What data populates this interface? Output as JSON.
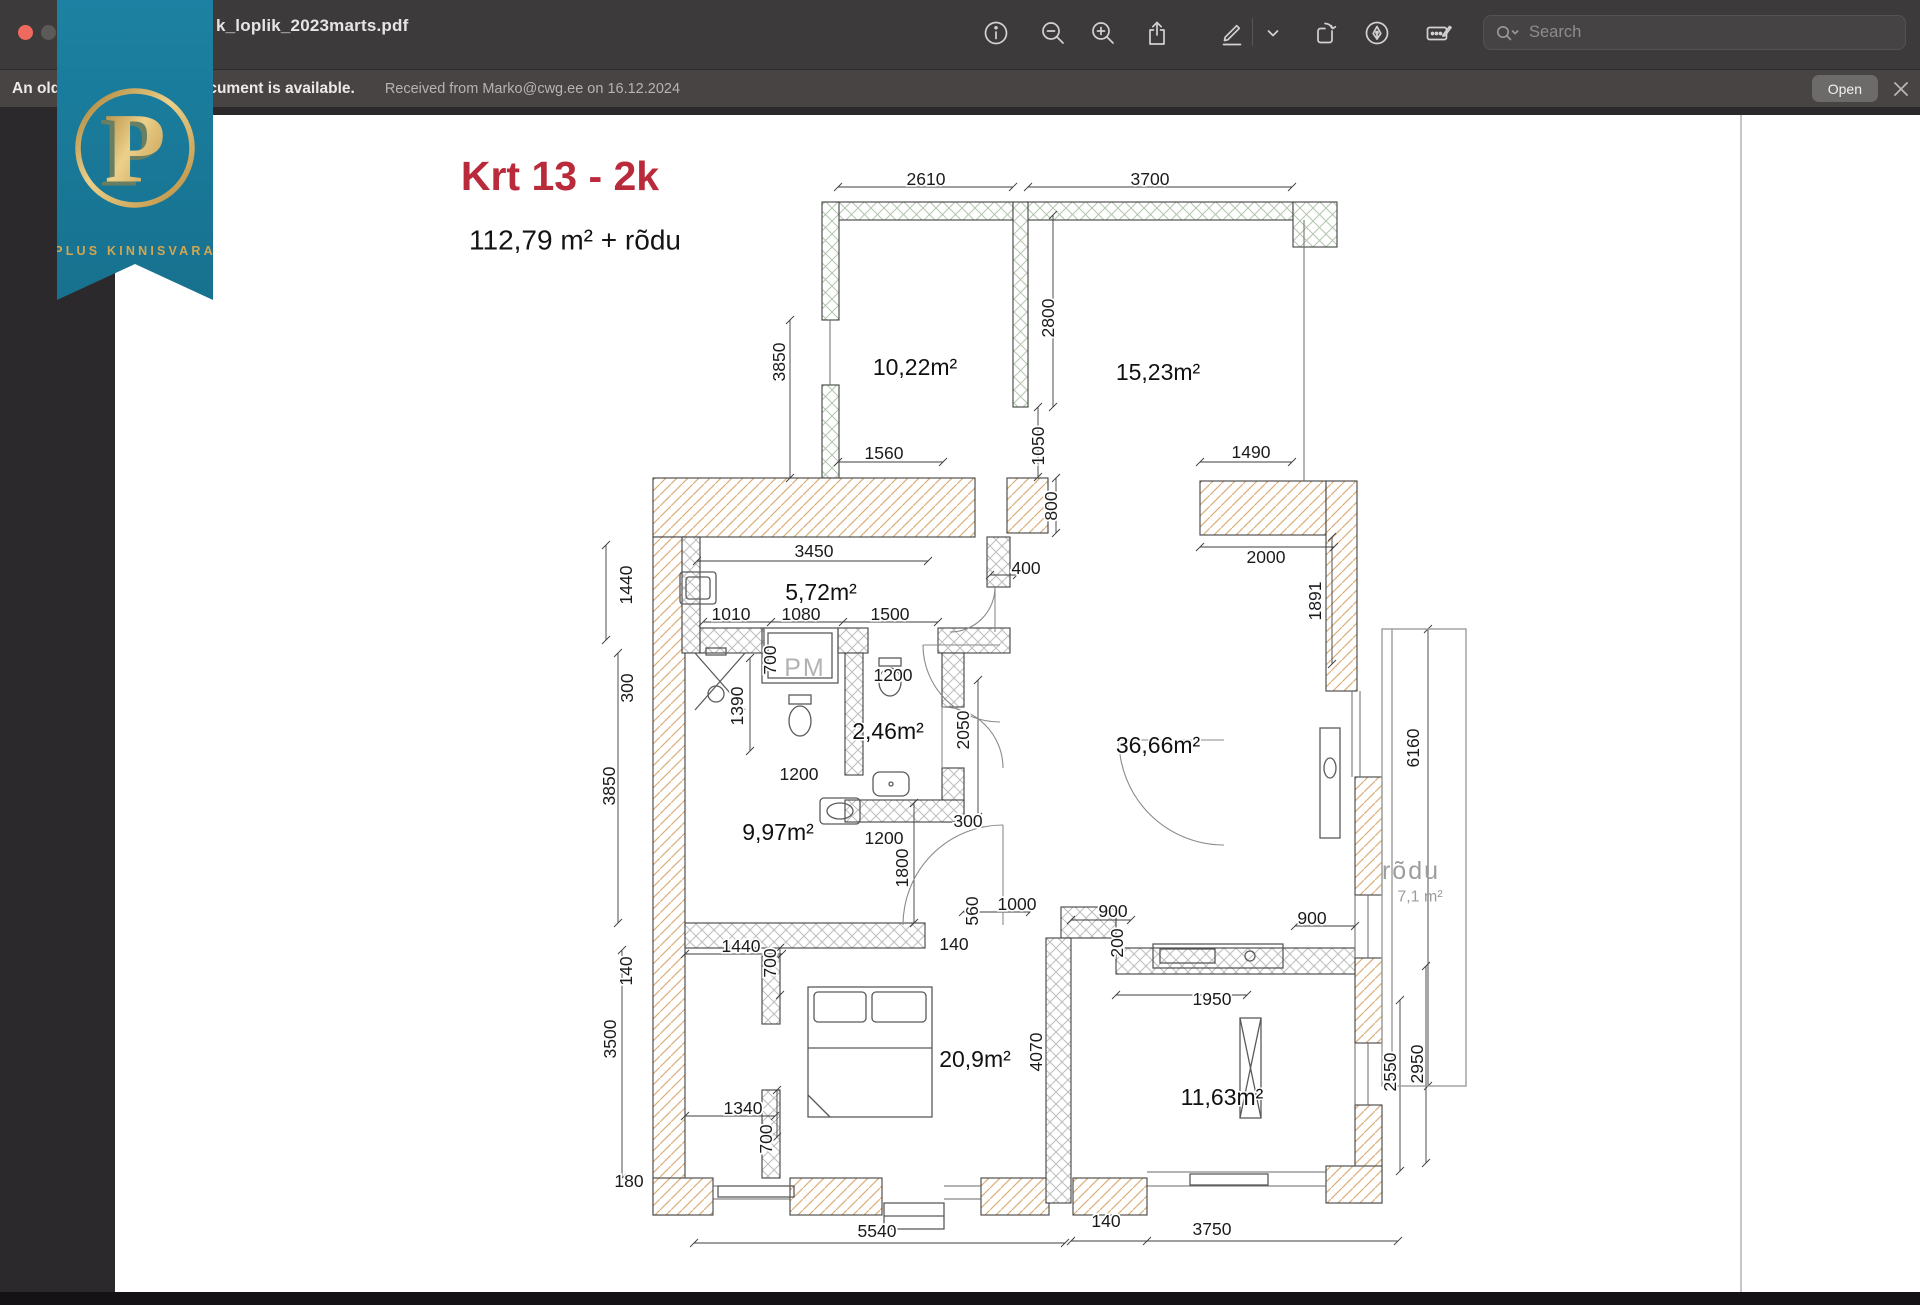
{
  "window": {
    "title": "k_loplik_2023marts.pdf",
    "toolbar": {
      "search_placeholder": "Search"
    },
    "notification": {
      "message": "An older version of this document is available.",
      "detail": "Received from Marko@cwg.ee on 16.12.2024",
      "open_label": "Open"
    }
  },
  "badge": {
    "letter": "P",
    "name": "PLUS KINNISVARA",
    "teal": "#1b7d9e",
    "gold": "#d2a74f"
  },
  "plan": {
    "title": "Krt 13 - 2k",
    "subtitle": "112,79 m² + rõdu",
    "title_color": "#b92a3b",
    "rooms": [
      "10,22m²",
      "15,23m²",
      "5,72m²",
      "2,46m²",
      "9,97m²",
      "36,66m²",
      "20,9m²",
      "11,63m²"
    ],
    "balcony": {
      "name": "rõdu",
      "area": "7,1 m²"
    },
    "labels": [
      {
        "t": "Krt 13 - 2k",
        "x": 560,
        "y": 176,
        "c": "title"
      },
      {
        "t": "112,79 m² + rõdu",
        "x": 575,
        "y": 240,
        "c": "sub"
      },
      {
        "t": "10,22m²",
        "x": 915,
        "y": 367,
        "c": "room"
      },
      {
        "t": "15,23m²",
        "x": 1158,
        "y": 372,
        "c": "room"
      },
      {
        "t": "5,72m²",
        "x": 821,
        "y": 592,
        "c": "room"
      },
      {
        "t": "2,46m²",
        "x": 888,
        "y": 731,
        "c": "room"
      },
      {
        "t": "9,97m²",
        "x": 778,
        "y": 832,
        "c": "room"
      },
      {
        "t": "36,66m²",
        "x": 1158,
        "y": 745,
        "c": "room"
      },
      {
        "t": "20,9m²",
        "x": 975,
        "y": 1059,
        "c": "room"
      },
      {
        "t": "11,63m²",
        "x": 1222,
        "y": 1097,
        "c": "room"
      },
      {
        "t": "PM",
        "x": 805,
        "y": 668,
        "c": "pm"
      },
      {
        "t": "rõdu",
        "x": 1411,
        "y": 871,
        "c": "balc"
      },
      {
        "t": "7,1 m²",
        "x": 1420,
        "y": 897,
        "c": "balc2"
      },
      {
        "t": "2610",
        "x": 926,
        "y": 179
      },
      {
        "t": "3700",
        "x": 1150,
        "y": 179
      },
      {
        "t": "3850",
        "x": 779,
        "y": 362,
        "r": 1
      },
      {
        "t": "2800",
        "x": 1048,
        "y": 318,
        "r": 1
      },
      {
        "t": "1050",
        "x": 1038,
        "y": 446,
        "r": 1
      },
      {
        "t": "800",
        "x": 1051,
        "y": 506,
        "r": 1
      },
      {
        "t": "400",
        "x": 1026,
        "y": 568
      },
      {
        "t": "1560",
        "x": 884,
        "y": 453
      },
      {
        "t": "1490",
        "x": 1251,
        "y": 452
      },
      {
        "t": "2000",
        "x": 1266,
        "y": 557
      },
      {
        "t": "1891",
        "x": 1315,
        "y": 601,
        "r": 1
      },
      {
        "t": "3450",
        "x": 814,
        "y": 551
      },
      {
        "t": "1440",
        "x": 626,
        "y": 585,
        "r": 1
      },
      {
        "t": "1010",
        "x": 731,
        "y": 614
      },
      {
        "t": "1080",
        "x": 801,
        "y": 614
      },
      {
        "t": "1500",
        "x": 890,
        "y": 614
      },
      {
        "t": "700",
        "x": 770,
        "y": 660,
        "r": 1
      },
      {
        "t": "300",
        "x": 627,
        "y": 688,
        "r": 1
      },
      {
        "t": "1390",
        "x": 737,
        "y": 706,
        "r": 1
      },
      {
        "t": "1200",
        "x": 893,
        "y": 675
      },
      {
        "t": "2050",
        "x": 963,
        "y": 730,
        "r": 1
      },
      {
        "t": "1200",
        "x": 799,
        "y": 774
      },
      {
        "t": "300",
        "x": 968,
        "y": 821
      },
      {
        "t": "1200",
        "x": 884,
        "y": 838
      },
      {
        "t": "1800",
        "x": 902,
        "y": 868,
        "r": 1
      },
      {
        "t": "3850",
        "x": 609,
        "y": 786,
        "r": 1
      },
      {
        "t": "560",
        "x": 972,
        "y": 911,
        "r": 1
      },
      {
        "t": "1000",
        "x": 1017,
        "y": 904
      },
      {
        "t": "140",
        "x": 954,
        "y": 944
      },
      {
        "t": "900",
        "x": 1113,
        "y": 911
      },
      {
        "t": "200",
        "x": 1117,
        "y": 943,
        "r": 1
      },
      {
        "t": "900",
        "x": 1312,
        "y": 918
      },
      {
        "t": "1950",
        "x": 1212,
        "y": 999
      },
      {
        "t": "6160",
        "x": 1413,
        "y": 748,
        "r": 1
      },
      {
        "t": "2550",
        "x": 1390,
        "y": 1072,
        "r": 1
      },
      {
        "t": "2950",
        "x": 1417,
        "y": 1064,
        "r": 1
      },
      {
        "t": "4070",
        "x": 1036,
        "y": 1052,
        "r": 1
      },
      {
        "t": "1440",
        "x": 741,
        "y": 946
      },
      {
        "t": "700",
        "x": 770,
        "y": 963,
        "r": 1
      },
      {
        "t": "140",
        "x": 626,
        "y": 971,
        "r": 1
      },
      {
        "t": "3500",
        "x": 610,
        "y": 1039,
        "r": 1
      },
      {
        "t": "1340",
        "x": 743,
        "y": 1108
      },
      {
        "t": "700",
        "x": 766,
        "y": 1139,
        "r": 1
      },
      {
        "t": "180",
        "x": 629,
        "y": 1181
      },
      {
        "t": "5540",
        "x": 877,
        "y": 1231
      },
      {
        "t": "140",
        "x": 1106,
        "y": 1221
      },
      {
        "t": "3750",
        "x": 1212,
        "y": 1229
      }
    ]
  }
}
